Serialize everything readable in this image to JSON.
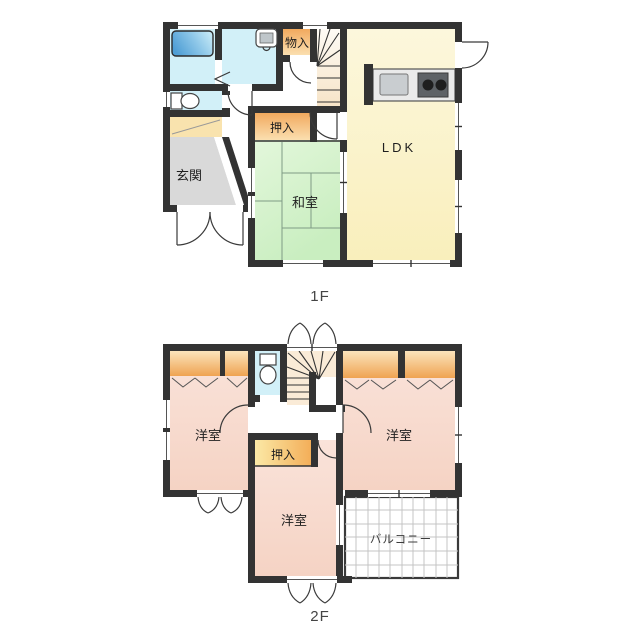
{
  "palette": {
    "wall": "#333333",
    "window_line": "#555555",
    "tatami_line": "#7f9b85",
    "bath": "#D2F0F8",
    "balcony_grid": "#C4C4C4",
    "genkan_cabinet": "#F9E3AE",
    "genkan_floor": "#D9D9D9",
    "counter": "#EAEAEA",
    "sink": "#C9CDD0",
    "stove": "#5E6266",
    "burner": "#1E1E1E",
    "text": "#1F1F1F",
    "floor_label": "#444444"
  },
  "floor1": {
    "label": "1F",
    "rooms": {
      "ldk": "LDK",
      "washitsu": "和室",
      "oshiire": "押入",
      "monoire": "物入",
      "genkan": "玄関"
    }
  },
  "floor2": {
    "label": "2F",
    "rooms": {
      "yoshitsu_left": "洋室",
      "yoshitsu_right": "洋室",
      "yoshitsu_bottom": "洋室",
      "oshiire": "押入",
      "balcony": "バルコニー"
    }
  }
}
